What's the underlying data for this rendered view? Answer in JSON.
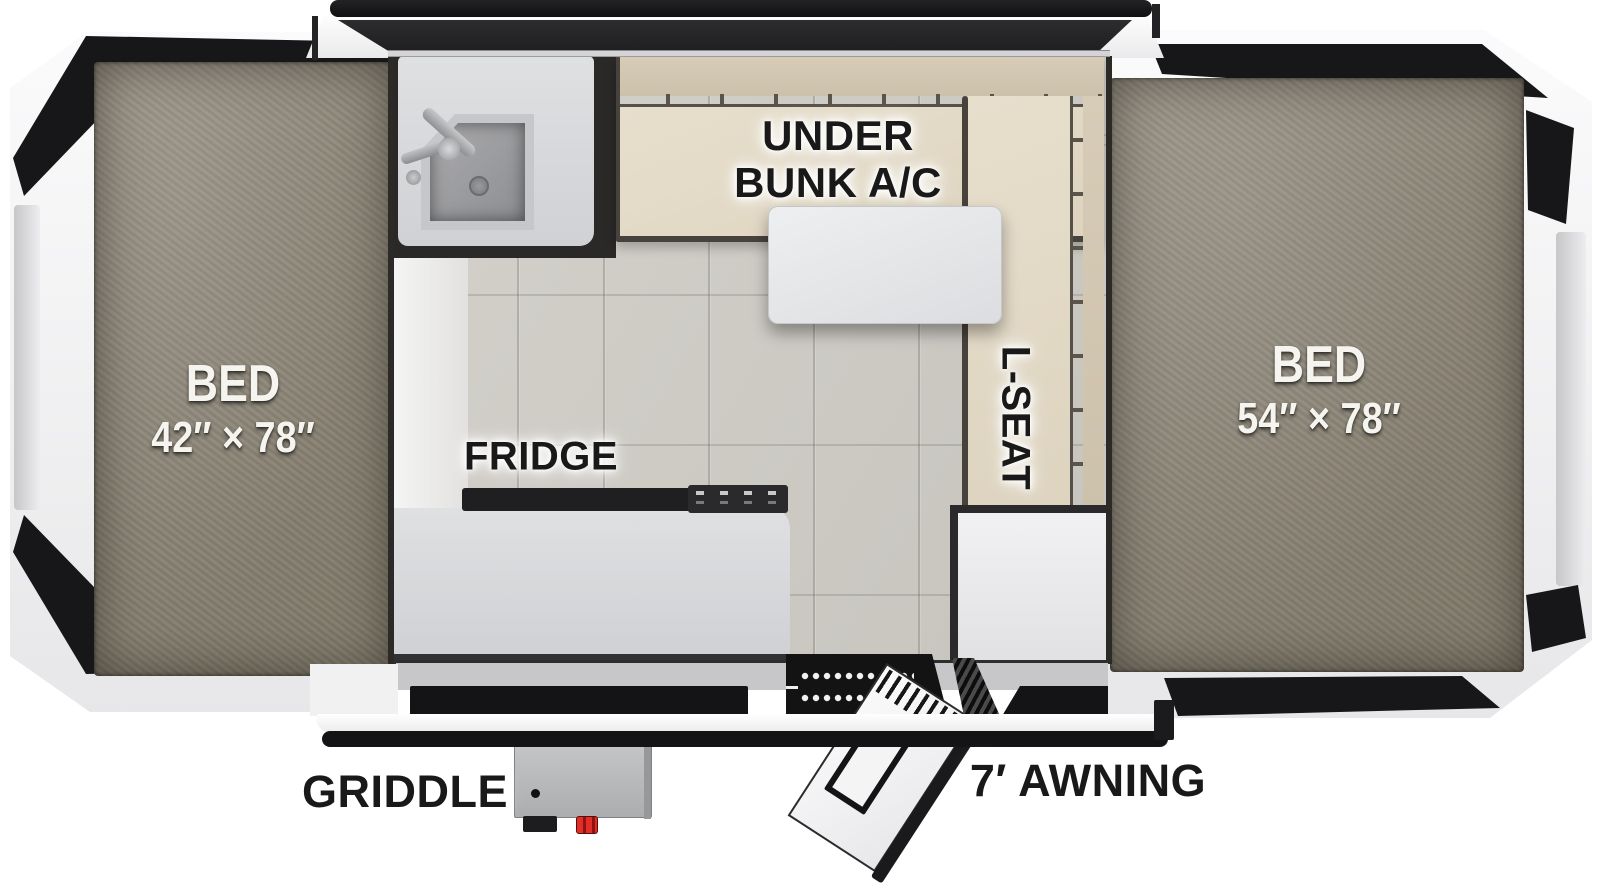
{
  "labels": {
    "bed_left": {
      "line1": "BED",
      "line2": "42″ × 78″"
    },
    "bed_right": {
      "line1": "BED",
      "line2": "54″ × 78″"
    },
    "under_bunk_ac": {
      "line1": "UNDER",
      "line2": "BUNK A/C"
    },
    "l_seat": "L-SEAT",
    "fridge": "FRIDGE",
    "griddle": "GRIDDLE",
    "awning": "7′ AWNING"
  },
  "colors": {
    "cushion_beige": "#e4dbc8",
    "cushion_back_beige": "#d2c7b2",
    "mattress_gray": "#8e877b",
    "floor_tile": "#cfccc6",
    "counter_gray": "#dadbdd",
    "tent_black": "#141416",
    "valve_red": "#df2f28"
  }
}
